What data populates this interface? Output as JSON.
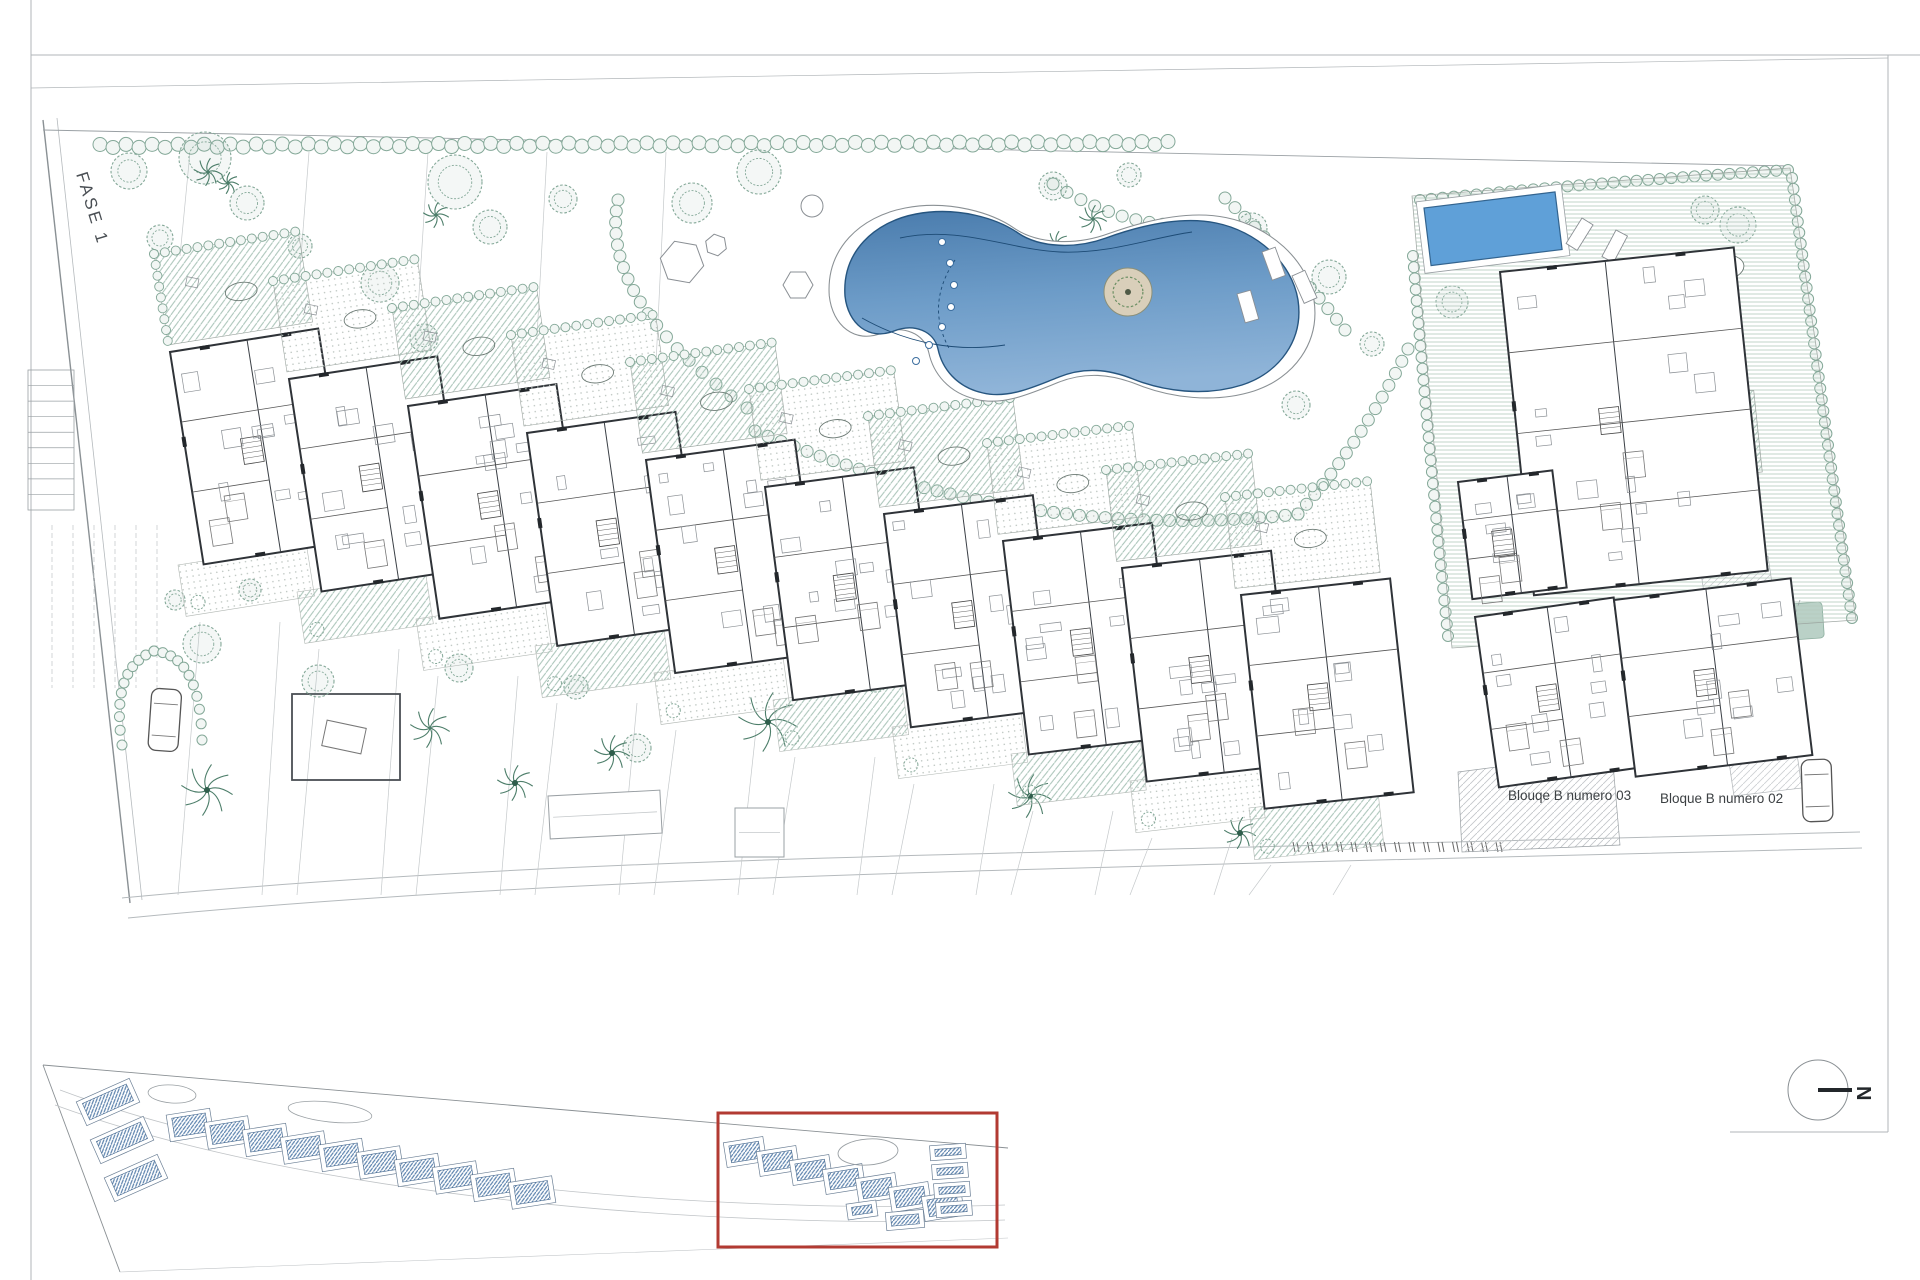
{
  "labels": {
    "fase": "FASE 1",
    "bloque03": "Blouqe B numero 03",
    "bloque02": "Bloque B numero 02",
    "north": "N"
  },
  "colors": {
    "wall": "#2f3338",
    "thinWall": "#6a6f74",
    "veg": "#84a898",
    "vegDark": "#4d7e6a",
    "hatchGreen": "#a8c3b7",
    "gray": "#9aa0a4",
    "lightGray": "#c5c9cb",
    "poolTop": "#4a7cad",
    "poolMid": "#6d9cc8",
    "poolBottom": "#8fb4d8",
    "poolStroke": "#26557f",
    "privatePool": "#5fa0d8",
    "red": "#b23a32",
    "roofBlue": "#5b82ad",
    "text": "#3c4043",
    "sand": "#d9cfba"
  },
  "frame": {
    "lines": [
      [
        31,
        0,
        31,
        1280
      ],
      [
        31,
        55,
        1920,
        55
      ],
      [
        1888,
        55,
        1888,
        1132
      ],
      [
        1730,
        1132,
        1888,
        1132
      ],
      [
        31,
        88,
        1888,
        58
      ]
    ]
  },
  "site": {
    "leftBoundary": [
      [
        43,
        120
      ],
      [
        130,
        903
      ]
    ],
    "leftBoundary2": [
      [
        57,
        118
      ],
      [
        142,
        900
      ]
    ],
    "topBoundary": [
      [
        43,
        130
      ],
      [
        1790,
        166
      ]
    ],
    "roads": [
      "M122,898 C500,862 900,856 1290,846 L1860,832",
      "M128,918 C520,880 940,872 1300,862 L1862,848"
    ],
    "minorRoads": [
      "M60,1090 C300,1180 700,1215 1005,1205",
      "M55,1105 C300,1195 700,1230 1005,1220"
    ]
  },
  "cascade": {
    "count": 10,
    "x0": 170,
    "y0": 352,
    "dx": 119,
    "dy": 27,
    "w": 150,
    "h": 215,
    "rot": -9
  },
  "pool": {
    "d": "M845,296 C842,252 874,222 916,214 C958,206 998,219 1018,233 C1040,248 1076,249 1106,238 C1142,225 1182,216 1216,223 C1256,231 1292,262 1298,300 C1304,340 1279,373 1242,385 C1204,397 1163,391 1133,379 C1108,369 1084,367 1059,377 C1034,387 1008,399 983,393 C956,387 942,368 938,349 C934,331 914,323 894,331 C869,341 848,324 845,296 Z",
    "island": [
      1128,
      292,
      24
    ],
    "dots": [
      [
        942,
        242
      ],
      [
        950,
        263
      ],
      [
        954,
        285
      ],
      [
        951,
        307
      ],
      [
        942,
        327
      ],
      [
        929,
        345
      ],
      [
        916,
        361
      ]
    ],
    "curves": [
      "M900,238 C960,225 1010,250 1060,252 C1110,254 1150,238 1192,232",
      "M862,318 C910,345 960,352 1005,345"
    ],
    "dashCurve": "M955,260 C935,290 933,320 950,350"
  },
  "poolSide": {
    "hexagons": [
      [
        682,
        262,
        22,
        10
      ],
      [
        798,
        285,
        15,
        0
      ],
      [
        716,
        245,
        11,
        20
      ]
    ],
    "circle": [
      812,
      206,
      11
    ],
    "loungers": [
      [
        1262,
        252,
        -20
      ],
      [
        1292,
        276,
        -24
      ],
      [
        1237,
        294,
        -16
      ]
    ]
  },
  "hedges": [
    {
      "p": [
        [
          755,
          431
        ],
        [
          1029,
          545
        ],
        [
          1298,
          514
        ]
      ],
      "r": 6,
      "step": 15
    },
    {
      "p": [
        [
          1298,
          514
        ],
        [
          1362,
          442
        ],
        [
          1408,
          349
        ]
      ],
      "r": 6,
      "step": 15
    },
    {
      "p": [
        [
          618,
          200
        ],
        [
          598,
          300
        ],
        [
          747,
          408
        ]
      ],
      "r": 6,
      "step": 15
    },
    {
      "p": [
        [
          1225,
          198
        ],
        [
          1290,
          260
        ],
        [
          1345,
          330
        ]
      ],
      "r": 6,
      "step": 15
    },
    {
      "p": [
        [
          1053,
          184
        ],
        [
          1130,
          232
        ],
        [
          1203,
          224
        ]
      ],
      "r": 6,
      "step": 15
    },
    {
      "p": [
        [
          1420,
          200
        ],
        [
          1600,
          182
        ],
        [
          1788,
          170
        ]
      ],
      "r": 5.5,
      "step": 13
    },
    {
      "p": [
        [
          1792,
          178
        ],
        [
          1820,
          390
        ],
        [
          1852,
          618
        ]
      ],
      "r": 5.5,
      "step": 13
    },
    {
      "p": [
        [
          1413,
          256
        ],
        [
          1428,
          440
        ],
        [
          1448,
          636
        ]
      ],
      "r": 5.5,
      "step": 13
    },
    {
      "p": [
        [
          122,
          745
        ],
        [
          110,
          668
        ],
        [
          154,
          651
        ]
      ],
      "r": 5,
      "step": 11
    },
    {
      "p": [
        [
          154,
          651
        ],
        [
          200,
          655
        ],
        [
          202,
          740
        ]
      ],
      "r": 5,
      "step": 11
    }
  ],
  "bushRow": {
    "x1": 100,
    "y1": 146,
    "x2": 1168,
    "y2": 143,
    "r": 7,
    "step": 13
  },
  "trees": [
    [
      129,
      171,
      18
    ],
    [
      160,
      238,
      13
    ],
    [
      205,
      158,
      26
    ],
    [
      247,
      203,
      17
    ],
    [
      300,
      246,
      12
    ],
    [
      455,
      182,
      27
    ],
    [
      490,
      227,
      17
    ],
    [
      563,
      199,
      14
    ],
    [
      692,
      203,
      20
    ],
    [
      759,
      172,
      22
    ],
    [
      1053,
      186,
      14
    ],
    [
      1129,
      175,
      12
    ],
    [
      1252,
      228,
      15
    ],
    [
      1329,
      277,
      17
    ],
    [
      1372,
      344,
      12
    ],
    [
      1296,
      405,
      14
    ],
    [
      380,
      283,
      19
    ],
    [
      424,
      338,
      14
    ],
    [
      202,
      644,
      19
    ],
    [
      318,
      681,
      16
    ],
    [
      459,
      668,
      14
    ],
    [
      576,
      687,
      12
    ],
    [
      637,
      748,
      14
    ],
    [
      250,
      590,
      11
    ],
    [
      175,
      600,
      10
    ],
    [
      876,
      680,
      12
    ],
    [
      955,
      700,
      10
    ],
    [
      1127,
      698,
      11
    ],
    [
      1213,
      368,
      12
    ],
    [
      1705,
      210,
      14
    ],
    [
      1738,
      225,
      18
    ],
    [
      1452,
      302,
      16
    ]
  ],
  "palms": [
    [
      208,
      172,
      14,
      0
    ],
    [
      228,
      183,
      11,
      0
    ],
    [
      436,
      215,
      13,
      0
    ],
    [
      1093,
      219,
      14,
      0
    ],
    [
      1057,
      243,
      12,
      0
    ],
    [
      1108,
      298,
      16,
      0
    ],
    [
      207,
      790,
      26,
      1
    ],
    [
      430,
      728,
      20,
      0
    ],
    [
      515,
      783,
      18,
      1
    ],
    [
      612,
      753,
      18,
      1
    ],
    [
      768,
      722,
      30,
      1
    ],
    [
      1030,
      796,
      22,
      1
    ],
    [
      1240,
      833,
      16,
      1
    ]
  ],
  "topRight": {
    "garden": "1412,196 1790,168 1856,620 1452,648",
    "privatePool": {
      "x": 1424,
      "y": 208,
      "w": 132,
      "h": 58,
      "rot": -7
    },
    "bigBuilding": {
      "x": 1500,
      "y": 272,
      "w": 235,
      "h": 325,
      "rot": -6
    },
    "medBuilding": {
      "x": 1458,
      "y": 482,
      "w": 95,
      "h": 118,
      "rot": -7
    },
    "greenTerrace": {
      "x": 1700,
      "y": 396,
      "w": 54,
      "h": 82,
      "rot": -6
    },
    "tables": [
      [
        1718,
        268,
        26,
        14,
        -6
      ],
      [
        1700,
        470,
        24,
        13,
        -6
      ]
    ],
    "loungers": [
      [
        1582,
        218,
        32
      ],
      [
        1616,
        230,
        28
      ]
    ]
  },
  "wings": [
    {
      "x": 1475,
      "y": 617,
      "w": 140,
      "h": 172,
      "rot": -8
    },
    {
      "x": 1614,
      "y": 600,
      "w": 178,
      "h": 178,
      "rot": -7
    }
  ],
  "hatches": {
    "labelGround": "1458,772 1612,752 1620,845 1462,852",
    "strip": "1700,566 1768,556 1802,788 1734,796",
    "greenPatch": {
      "x": 1762,
      "y": 606,
      "w": 60,
      "h": 36,
      "rot": -4
    },
    "splays": [
      [
        1742,
        600,
        1800,
        755
      ],
      [
        1800,
        600,
        1745,
        755
      ]
    ]
  },
  "labelPos": {
    "bloque03": [
      1508,
      800
    ],
    "bloque02": [
      1660,
      803
    ],
    "fase": [
      76,
      174,
      73
    ]
  },
  "cars": [
    {
      "x": 152,
      "y": 688,
      "rot": 4
    },
    {
      "x": 1801,
      "y": 760,
      "rot": -2
    }
  ],
  "stairs": {
    "x": 28,
    "y": 370,
    "w": 46,
    "h": 140,
    "n": 9
  },
  "parkingGrid": {
    "x0": 52,
    "y1": 525,
    "y2": 688,
    "n": 6,
    "dx": 21
  },
  "planter": {
    "x": 292,
    "y": 694,
    "w": 108,
    "h": 86
  },
  "pergolas": [
    {
      "x": 548,
      "y": 796,
      "w": 112,
      "h": 43,
      "rot": -3
    },
    {
      "x": 735,
      "y": 808,
      "w": 49,
      "h": 49,
      "rot": 0
    }
  ],
  "parkTicks": {
    "x0": 1293,
    "y0": 847,
    "n": 15,
    "dx": 14.5
  },
  "minimap": {
    "topLine": [
      [
        43,
        1065
      ],
      [
        1008,
        1148
      ]
    ],
    "leftLine": [
      [
        43,
        1065
      ],
      [
        120,
        1272
      ]
    ],
    "bottomLine": [
      [
        120,
        1272
      ],
      [
        1008,
        1238
      ]
    ],
    "leftGroup": {
      "items": [
        [
          108,
          1102
        ],
        [
          122,
          1140
        ],
        [
          136,
          1178
        ]
      ],
      "w": 58,
      "h": 26,
      "rot": -24
    },
    "chain1": {
      "x0": 190,
      "y0": 1125,
      "dx": 38,
      "dy": 7.5,
      "n": 10,
      "w": 44,
      "h": 27,
      "rot": -9
    },
    "chain2": {
      "x0": 745,
      "y0": 1152,
      "dx": 33,
      "dy": 9,
      "n": 7,
      "w": 40,
      "h": 25,
      "rot": -9
    },
    "stack": {
      "x0": 948,
      "y0": 1152,
      "dy": 19,
      "n": 4,
      "w": 36,
      "h": 15,
      "rot": -4
    },
    "extras": [
      [
        905,
        1220,
        38,
        18,
        -5
      ],
      [
        862,
        1210,
        30,
        16,
        -8
      ]
    ],
    "ponds": [
      [
        172,
        1094,
        24,
        9,
        4
      ],
      [
        330,
        1112,
        42,
        10,
        6
      ]
    ],
    "poolBlob": [
      868,
      1152,
      30,
      13,
      -4
    ],
    "redBox": {
      "x": 718,
      "y": 1113,
      "w": 279,
      "h": 134
    }
  },
  "compass": {
    "cx": 1818,
    "cy": 1090,
    "r": 30
  }
}
